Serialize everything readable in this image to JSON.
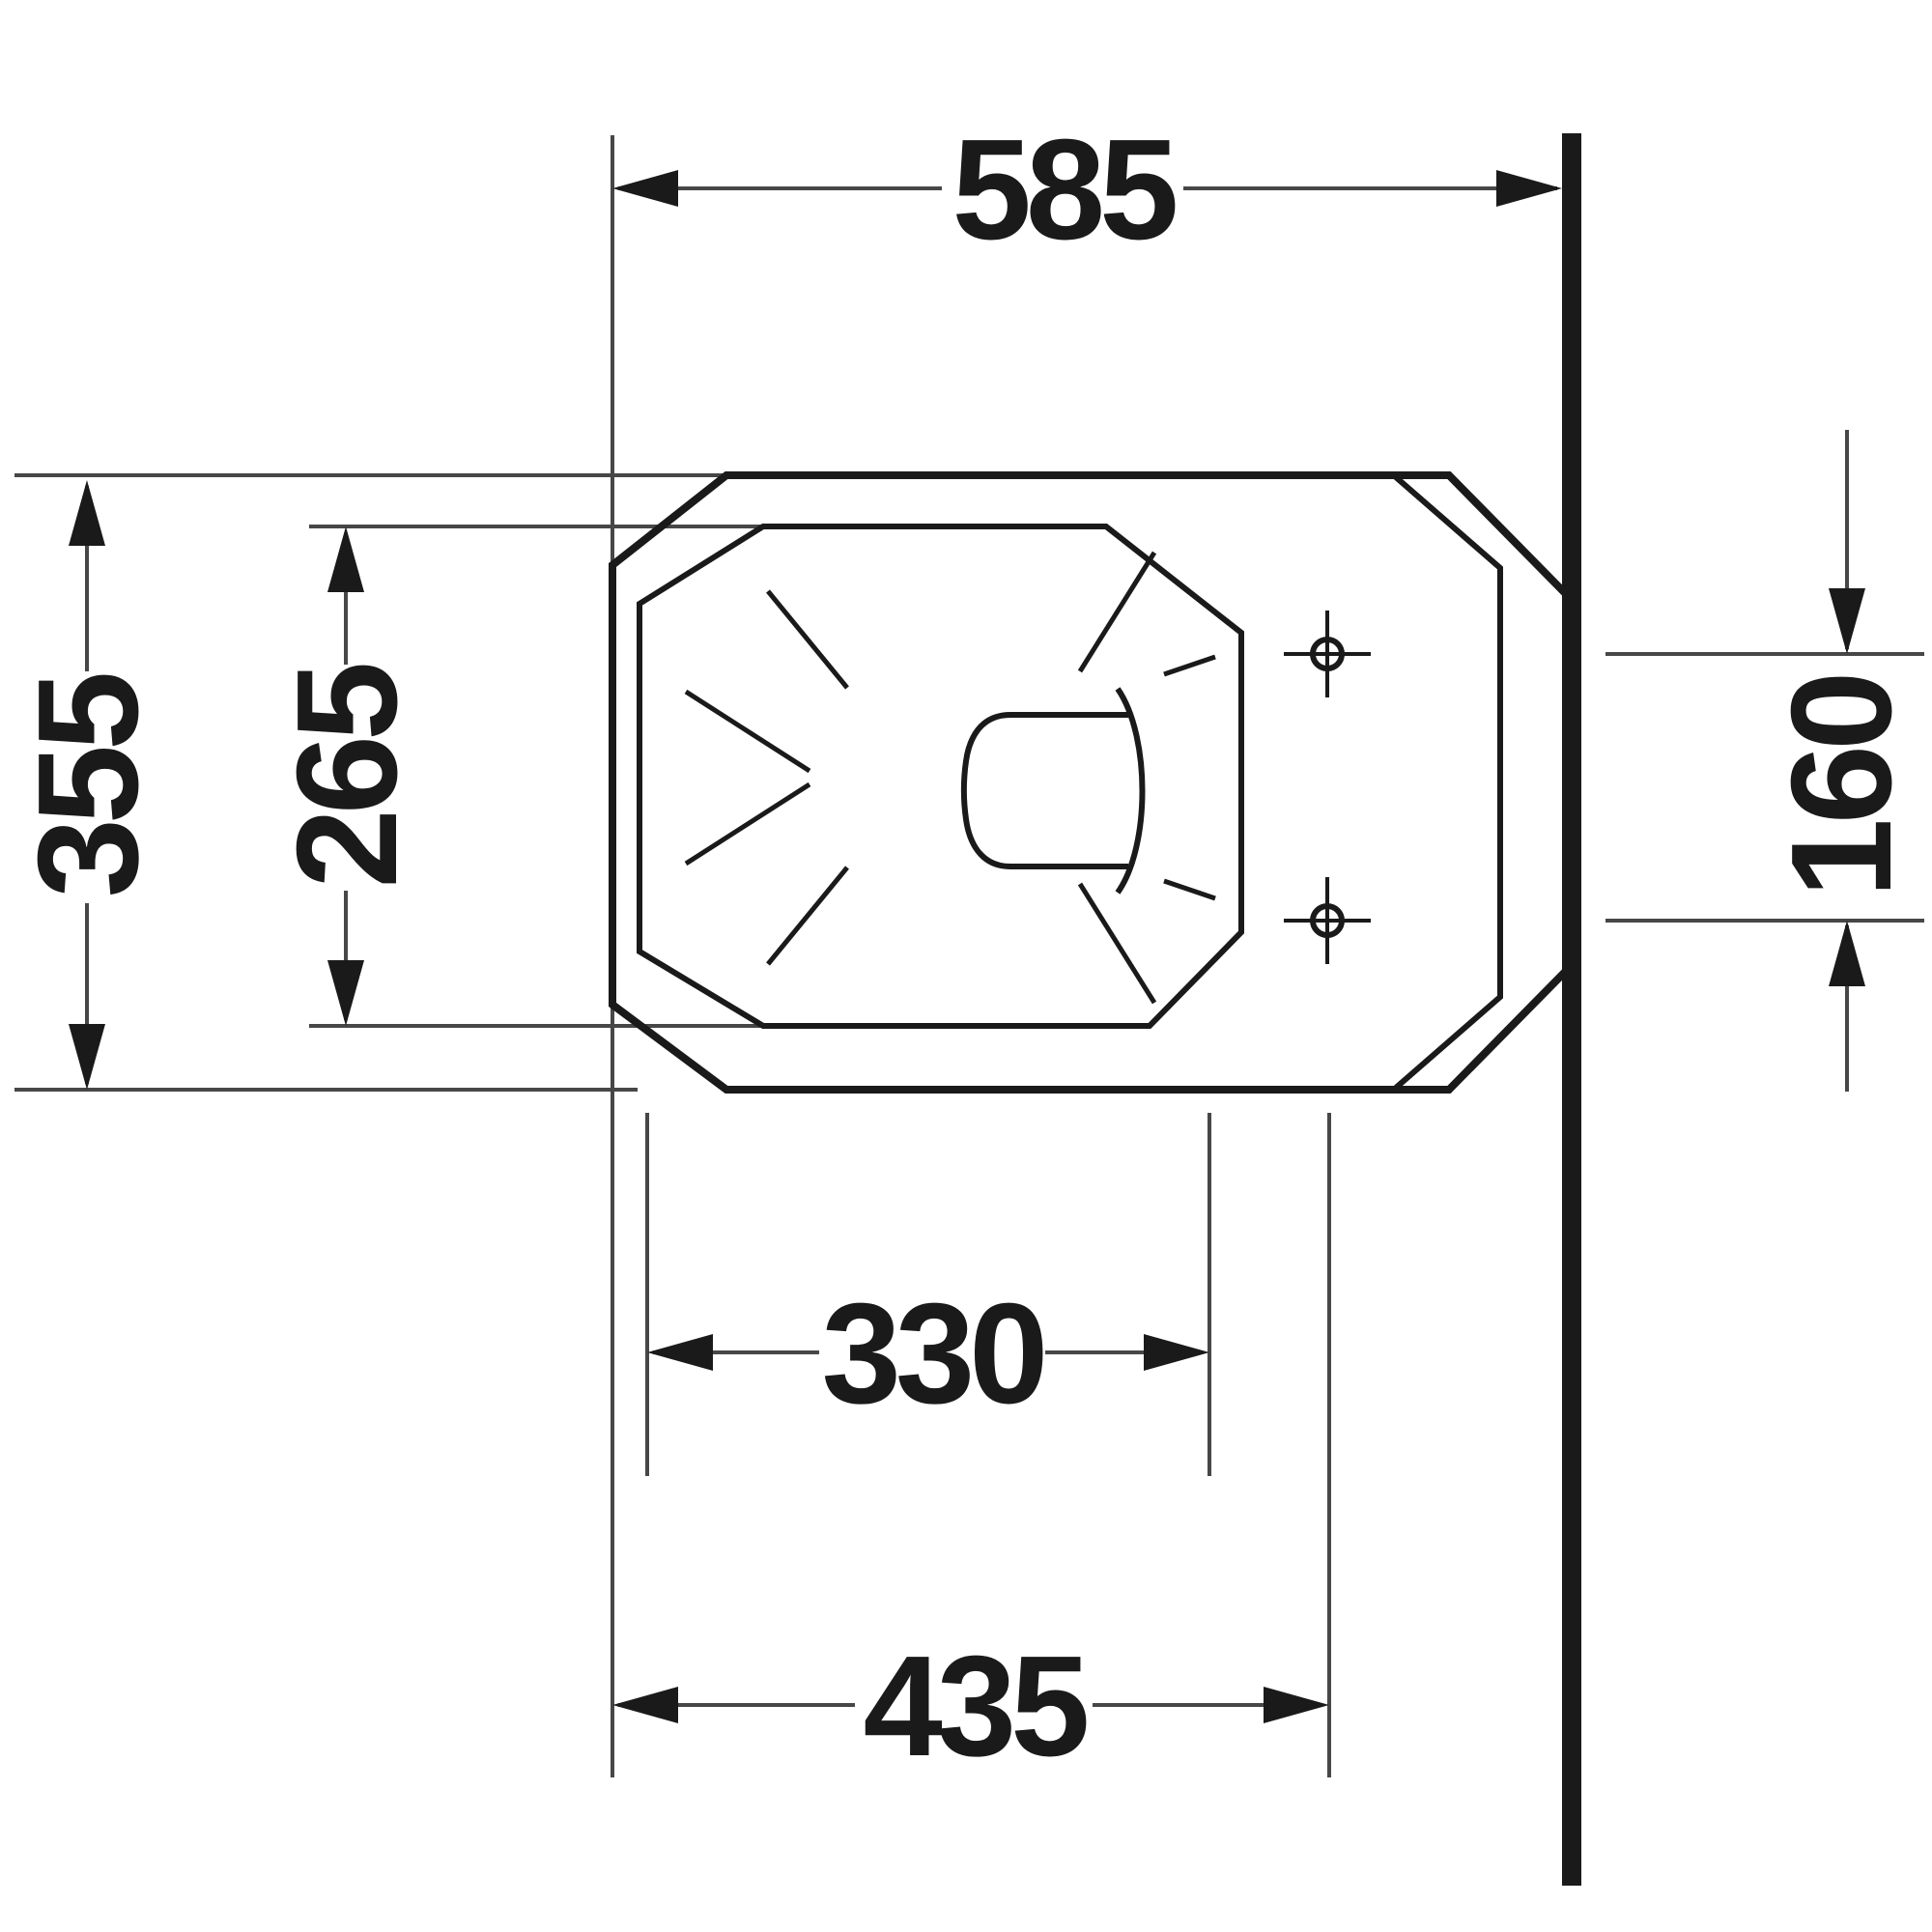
{
  "drawing": {
    "kind": "technical plan-view dimension drawing of a floor-standing toilet against a wall",
    "background": "#ffffff",
    "ink_color": "#1a1a1a",
    "thin_line_color": "#474747"
  },
  "dimensions": {
    "total_depth": "585",
    "overall_width": "355",
    "inner_bowl_width": "265",
    "fixing_hole_spacing": "160",
    "inner_bowl_depth": "330",
    "front_to_fixing_holes": "435"
  }
}
